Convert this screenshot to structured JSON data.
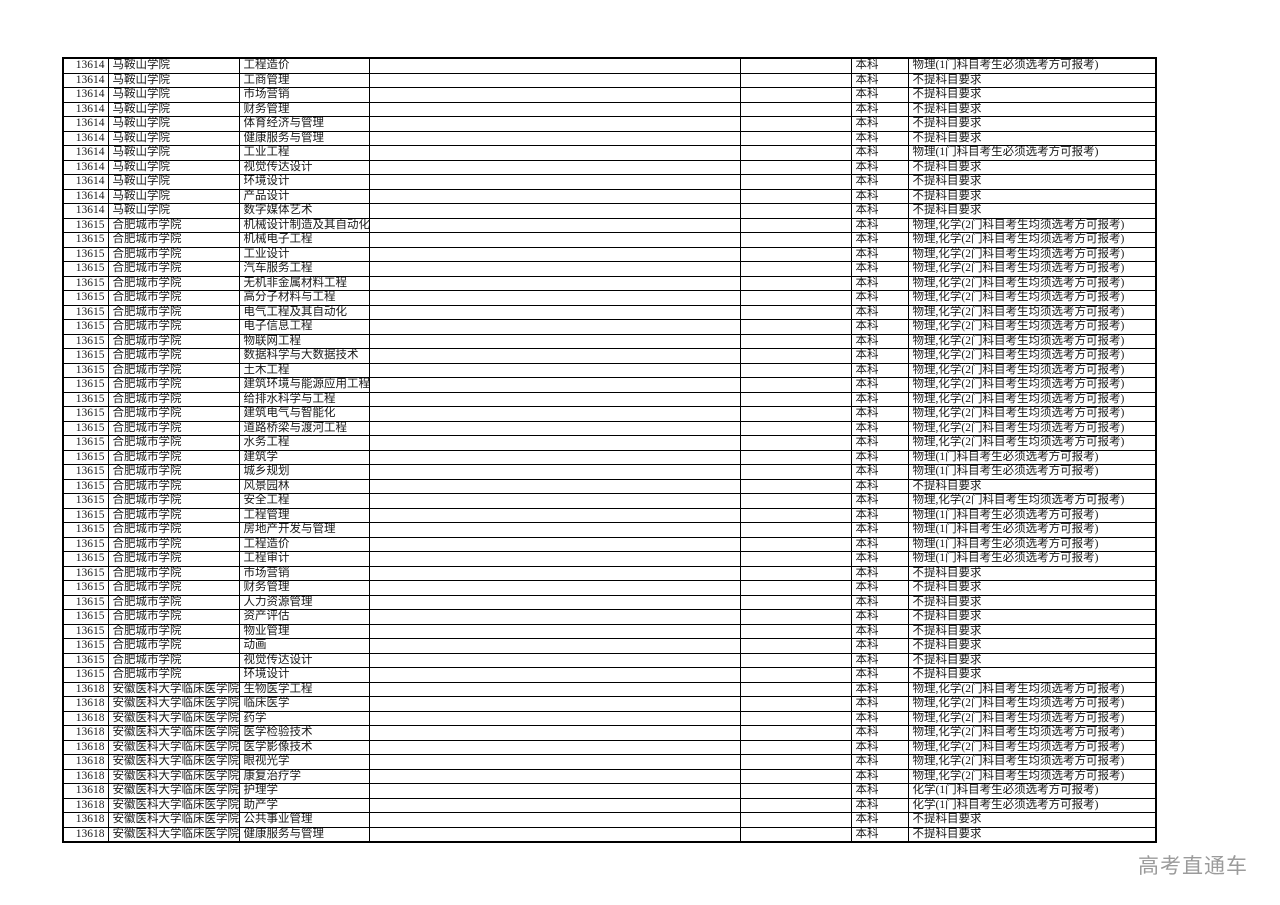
{
  "watermark": "高考直通车",
  "table": {
    "rows": [
      {
        "code": "13614",
        "school": "马鞍山学院",
        "major": "工程造价",
        "level": "本科",
        "requirement": "物理(1门科目考生必须选考方可报考)"
      },
      {
        "code": "13614",
        "school": "马鞍山学院",
        "major": "工商管理",
        "level": "本科",
        "requirement": "不提科目要求"
      },
      {
        "code": "13614",
        "school": "马鞍山学院",
        "major": "市场营销",
        "level": "本科",
        "requirement": "不提科目要求"
      },
      {
        "code": "13614",
        "school": "马鞍山学院",
        "major": "财务管理",
        "level": "本科",
        "requirement": "不提科目要求"
      },
      {
        "code": "13614",
        "school": "马鞍山学院",
        "major": "体育经济与管理",
        "level": "本科",
        "requirement": "不提科目要求"
      },
      {
        "code": "13614",
        "school": "马鞍山学院",
        "major": "健康服务与管理",
        "level": "本科",
        "requirement": "不提科目要求"
      },
      {
        "code": "13614",
        "school": "马鞍山学院",
        "major": "工业工程",
        "level": "本科",
        "requirement": "物理(1门科目考生必须选考方可报考)"
      },
      {
        "code": "13614",
        "school": "马鞍山学院",
        "major": "视觉传达设计",
        "level": "本科",
        "requirement": "不提科目要求"
      },
      {
        "code": "13614",
        "school": "马鞍山学院",
        "major": "环境设计",
        "level": "本科",
        "requirement": "不提科目要求"
      },
      {
        "code": "13614",
        "school": "马鞍山学院",
        "major": "产品设计",
        "level": "本科",
        "requirement": "不提科目要求"
      },
      {
        "code": "13614",
        "school": "马鞍山学院",
        "major": "数字媒体艺术",
        "level": "本科",
        "requirement": "不提科目要求"
      },
      {
        "code": "13615",
        "school": "合肥城市学院",
        "major": "机械设计制造及其自动化",
        "level": "本科",
        "requirement": "物理,化学(2门科目考生均须选考方可报考)"
      },
      {
        "code": "13615",
        "school": "合肥城市学院",
        "major": "机械电子工程",
        "level": "本科",
        "requirement": "物理,化学(2门科目考生均须选考方可报考)"
      },
      {
        "code": "13615",
        "school": "合肥城市学院",
        "major": "工业设计",
        "level": "本科",
        "requirement": "物理,化学(2门科目考生均须选考方可报考)"
      },
      {
        "code": "13615",
        "school": "合肥城市学院",
        "major": "汽车服务工程",
        "level": "本科",
        "requirement": "物理,化学(2门科目考生均须选考方可报考)"
      },
      {
        "code": "13615",
        "school": "合肥城市学院",
        "major": "无机非金属材料工程",
        "level": "本科",
        "requirement": "物理,化学(2门科目考生均须选考方可报考)"
      },
      {
        "code": "13615",
        "school": "合肥城市学院",
        "major": "高分子材料与工程",
        "level": "本科",
        "requirement": "物理,化学(2门科目考生均须选考方可报考)"
      },
      {
        "code": "13615",
        "school": "合肥城市学院",
        "major": "电气工程及其自动化",
        "level": "本科",
        "requirement": "物理,化学(2门科目考生均须选考方可报考)"
      },
      {
        "code": "13615",
        "school": "合肥城市学院",
        "major": "电子信息工程",
        "level": "本科",
        "requirement": "物理,化学(2门科目考生均须选考方可报考)"
      },
      {
        "code": "13615",
        "school": "合肥城市学院",
        "major": "物联网工程",
        "level": "本科",
        "requirement": "物理,化学(2门科目考生均须选考方可报考)"
      },
      {
        "code": "13615",
        "school": "合肥城市学院",
        "major": "数据科学与大数据技术",
        "level": "本科",
        "requirement": "物理,化学(2门科目考生均须选考方可报考)"
      },
      {
        "code": "13615",
        "school": "合肥城市学院",
        "major": "土木工程",
        "level": "本科",
        "requirement": "物理,化学(2门科目考生均须选考方可报考)"
      },
      {
        "code": "13615",
        "school": "合肥城市学院",
        "major": "建筑环境与能源应用工程",
        "level": "本科",
        "requirement": "物理,化学(2门科目考生均须选考方可报考)"
      },
      {
        "code": "13615",
        "school": "合肥城市学院",
        "major": "给排水科学与工程",
        "level": "本科",
        "requirement": "物理,化学(2门科目考生均须选考方可报考)"
      },
      {
        "code": "13615",
        "school": "合肥城市学院",
        "major": "建筑电气与智能化",
        "level": "本科",
        "requirement": "物理,化学(2门科目考生均须选考方可报考)"
      },
      {
        "code": "13615",
        "school": "合肥城市学院",
        "major": "道路桥梁与渡河工程",
        "level": "本科",
        "requirement": "物理,化学(2门科目考生均须选考方可报考)"
      },
      {
        "code": "13615",
        "school": "合肥城市学院",
        "major": "水务工程",
        "level": "本科",
        "requirement": "物理,化学(2门科目考生均须选考方可报考)"
      },
      {
        "code": "13615",
        "school": "合肥城市学院",
        "major": "建筑学",
        "level": "本科",
        "requirement": "物理(1门科目考生必须选考方可报考)"
      },
      {
        "code": "13615",
        "school": "合肥城市学院",
        "major": "城乡规划",
        "level": "本科",
        "requirement": "物理(1门科目考生必须选考方可报考)"
      },
      {
        "code": "13615",
        "school": "合肥城市学院",
        "major": "风景园林",
        "level": "本科",
        "requirement": "不提科目要求"
      },
      {
        "code": "13615",
        "school": "合肥城市学院",
        "major": "安全工程",
        "level": "本科",
        "requirement": "物理,化学(2门科目考生均须选考方可报考)"
      },
      {
        "code": "13615",
        "school": "合肥城市学院",
        "major": "工程管理",
        "level": "本科",
        "requirement": "物理(1门科目考生必须选考方可报考)"
      },
      {
        "code": "13615",
        "school": "合肥城市学院",
        "major": "房地产开发与管理",
        "level": "本科",
        "requirement": "物理(1门科目考生必须选考方可报考)"
      },
      {
        "code": "13615",
        "school": "合肥城市学院",
        "major": "工程造价",
        "level": "本科",
        "requirement": "物理(1门科目考生必须选考方可报考)"
      },
      {
        "code": "13615",
        "school": "合肥城市学院",
        "major": "工程审计",
        "level": "本科",
        "requirement": "物理(1门科目考生必须选考方可报考)"
      },
      {
        "code": "13615",
        "school": "合肥城市学院",
        "major": "市场营销",
        "level": "本科",
        "requirement": "不提科目要求"
      },
      {
        "code": "13615",
        "school": "合肥城市学院",
        "major": "财务管理",
        "level": "本科",
        "requirement": "不提科目要求"
      },
      {
        "code": "13615",
        "school": "合肥城市学院",
        "major": "人力资源管理",
        "level": "本科",
        "requirement": "不提科目要求"
      },
      {
        "code": "13615",
        "school": "合肥城市学院",
        "major": "资产评估",
        "level": "本科",
        "requirement": "不提科目要求"
      },
      {
        "code": "13615",
        "school": "合肥城市学院",
        "major": "物业管理",
        "level": "本科",
        "requirement": "不提科目要求"
      },
      {
        "code": "13615",
        "school": "合肥城市学院",
        "major": "动画",
        "level": "本科",
        "requirement": "不提科目要求"
      },
      {
        "code": "13615",
        "school": "合肥城市学院",
        "major": "视觉传达设计",
        "level": "本科",
        "requirement": "不提科目要求"
      },
      {
        "code": "13615",
        "school": "合肥城市学院",
        "major": "环境设计",
        "level": "本科",
        "requirement": "不提科目要求"
      },
      {
        "code": "13618",
        "school": "安徽医科大学临床医学院",
        "major": "生物医学工程",
        "level": "本科",
        "requirement": "物理,化学(2门科目考生均须选考方可报考)"
      },
      {
        "code": "13618",
        "school": "安徽医科大学临床医学院",
        "major": "临床医学",
        "level": "本科",
        "requirement": "物理,化学(2门科目考生均须选考方可报考)"
      },
      {
        "code": "13618",
        "school": "安徽医科大学临床医学院",
        "major": "药学",
        "level": "本科",
        "requirement": "物理,化学(2门科目考生均须选考方可报考)"
      },
      {
        "code": "13618",
        "school": "安徽医科大学临床医学院",
        "major": "医学检验技术",
        "level": "本科",
        "requirement": "物理,化学(2门科目考生均须选考方可报考)"
      },
      {
        "code": "13618",
        "school": "安徽医科大学临床医学院",
        "major": "医学影像技术",
        "level": "本科",
        "requirement": "物理,化学(2门科目考生均须选考方可报考)"
      },
      {
        "code": "13618",
        "school": "安徽医科大学临床医学院",
        "major": "眼视光学",
        "level": "本科",
        "requirement": "物理,化学(2门科目考生均须选考方可报考)"
      },
      {
        "code": "13618",
        "school": "安徽医科大学临床医学院",
        "major": "康复治疗学",
        "level": "本科",
        "requirement": "物理,化学(2门科目考生均须选考方可报考)"
      },
      {
        "code": "13618",
        "school": "安徽医科大学临床医学院",
        "major": "护理学",
        "level": "本科",
        "requirement": "化学(1门科目考生必须选考方可报考)"
      },
      {
        "code": "13618",
        "school": "安徽医科大学临床医学院",
        "major": "助产学",
        "level": "本科",
        "requirement": "化学(1门科目考生必须选考方可报考)"
      },
      {
        "code": "13618",
        "school": "安徽医科大学临床医学院",
        "major": "公共事业管理",
        "level": "本科",
        "requirement": "不提科目要求"
      },
      {
        "code": "13618",
        "school": "安徽医科大学临床医学院",
        "major": "健康服务与管理",
        "level": "本科",
        "requirement": "不提科目要求"
      }
    ]
  }
}
